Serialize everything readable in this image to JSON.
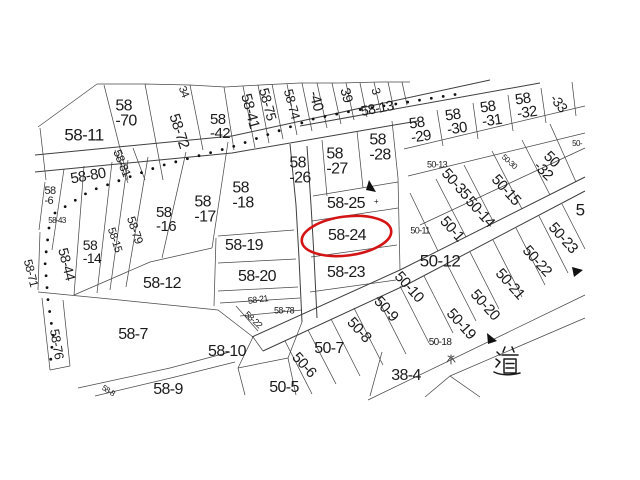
{
  "meta": {
    "type": "cadastral-parcel-map",
    "background_color": "#ffffff",
    "line_color": "#4a4a4a",
    "text_color": "#1b1b1b",
    "highlight_color": "#d41414",
    "highlighted_parcel": "58-24"
  },
  "map": {
    "road_label": "道",
    "water_mark": "水",
    "labels": [
      {
        "t": "58-11",
        "x": 84,
        "y": 135,
        "r": 0,
        "s": 17
      },
      {
        "t": "58\n-70",
        "x": 126,
        "y": 114,
        "r": 0,
        "s": 16
      },
      {
        "t": "58-72",
        "x": 179,
        "y": 131,
        "r": 72,
        "s": 15
      },
      {
        "t": "34",
        "x": 183,
        "y": 92,
        "r": 68,
        "s": 11
      },
      {
        "t": "58\n-42",
        "x": 220,
        "y": 127,
        "r": 0,
        "s": 15
      },
      {
        "t": "58-41",
        "x": 250,
        "y": 111,
        "r": 75,
        "s": 15
      },
      {
        "t": "58-75",
        "x": 268,
        "y": 104,
        "r": 75,
        "s": 14
      },
      {
        "t": "58-74",
        "x": 292,
        "y": 104,
        "r": 75,
        "s": 13
      },
      {
        "t": "-40",
        "x": 316,
        "y": 101,
        "r": 75,
        "s": 15
      },
      {
        "t": "39",
        "x": 347,
        "y": 95,
        "r": 75,
        "s": 14
      },
      {
        "t": "3",
        "x": 376,
        "y": 91,
        "r": 75,
        "s": 12
      },
      {
        "t": "58-13",
        "x": 377,
        "y": 108,
        "r": -11,
        "s": 14
      },
      {
        "t": "58\n-29",
        "x": 420,
        "y": 130,
        "r": -8,
        "s": 15
      },
      {
        "t": "58\n-30",
        "x": 456,
        "y": 122,
        "r": -8,
        "s": 15
      },
      {
        "t": "58\n-31",
        "x": 491,
        "y": 114,
        "r": -8,
        "s": 15
      },
      {
        "t": "58\n-32",
        "x": 526,
        "y": 106,
        "r": -8,
        "s": 15
      },
      {
        "t": "-33",
        "x": 559,
        "y": 103,
        "r": 52,
        "s": 14
      },
      {
        "t": "58-80",
        "x": 88,
        "y": 176,
        "r": -10,
        "s": 15
      },
      {
        "t": "58-81",
        "x": 122,
        "y": 163,
        "r": 68,
        "s": 12
      },
      {
        "t": "58\n-6",
        "x": 50,
        "y": 196,
        "r": 0,
        "s": 11
      },
      {
        "t": "58-43",
        "x": 57,
        "y": 221,
        "r": 0,
        "s": 8
      },
      {
        "t": "58-44",
        "x": 67,
        "y": 264,
        "r": 76,
        "s": 14
      },
      {
        "t": "58-71",
        "x": 31,
        "y": 273,
        "r": 76,
        "s": 12
      },
      {
        "t": "58\n-14",
        "x": 92,
        "y": 252,
        "r": 0,
        "s": 14
      },
      {
        "t": "58-15",
        "x": 114,
        "y": 240,
        "r": 72,
        "s": 11
      },
      {
        "t": "58-79",
        "x": 135,
        "y": 230,
        "r": 72,
        "s": 12
      },
      {
        "t": "58\n-16",
        "x": 166,
        "y": 220,
        "r": 0,
        "s": 15
      },
      {
        "t": "58\n-17",
        "x": 205,
        "y": 210,
        "r": 0,
        "s": 16
      },
      {
        "t": "58\n-18",
        "x": 243,
        "y": 196,
        "r": 0,
        "s": 16
      },
      {
        "t": "58-12",
        "x": 162,
        "y": 284,
        "r": 0,
        "s": 16
      },
      {
        "t": "58-19",
        "x": 244,
        "y": 246,
        "r": 0,
        "s": 16
      },
      {
        "t": "58-20",
        "x": 257,
        "y": 277,
        "r": 0,
        "s": 16
      },
      {
        "t": "58\n-26",
        "x": 300,
        "y": 171,
        "r": 0,
        "s": 16
      },
      {
        "t": "58\n-27",
        "x": 337,
        "y": 162,
        "r": 0,
        "s": 16
      },
      {
        "t": "58\n-28",
        "x": 380,
        "y": 148,
        "r": 0,
        "s": 16
      },
      {
        "t": "58-25",
        "x": 346,
        "y": 204,
        "r": 0,
        "s": 16
      },
      {
        "t": "58-24",
        "x": 347,
        "y": 236,
        "r": 0,
        "s": 16
      },
      {
        "t": "58-23",
        "x": 346,
        "y": 273,
        "r": 0,
        "s": 16
      },
      {
        "t": "58-76",
        "x": 57,
        "y": 344,
        "r": 80,
        "s": 13
      },
      {
        "t": "58-7",
        "x": 133,
        "y": 335,
        "r": 0,
        "s": 16
      },
      {
        "t": "58-9",
        "x": 168,
        "y": 390,
        "r": 0,
        "s": 16
      },
      {
        "t": "58-8",
        "x": 108,
        "y": 391,
        "r": 33,
        "s": 8
      },
      {
        "t": "58-10",
        "x": 227,
        "y": 352,
        "r": 0,
        "s": 16
      },
      {
        "t": "58-21",
        "x": 258,
        "y": 300,
        "r": -8,
        "s": 9
      },
      {
        "t": "58-78",
        "x": 284,
        "y": 311,
        "r": 0,
        "s": 9
      },
      {
        "t": "58-22",
        "x": 253,
        "y": 320,
        "r": 42,
        "s": 9
      },
      {
        "t": "50-13",
        "x": 437,
        "y": 165,
        "r": 0,
        "s": 9
      },
      {
        "t": "50-35",
        "x": 456,
        "y": 184,
        "r": 48,
        "s": 15
      },
      {
        "t": "50-30",
        "x": 509,
        "y": 162,
        "r": 42,
        "s": 8
      },
      {
        "t": "50\n-32",
        "x": 548,
        "y": 166,
        "r": 45,
        "s": 15
      },
      {
        "t": "50-15",
        "x": 506,
        "y": 190,
        "r": 48,
        "s": 15
      },
      {
        "t": "50-14",
        "x": 480,
        "y": 212,
        "r": 48,
        "s": 15
      },
      {
        "t": "50-1",
        "x": 452,
        "y": 229,
        "r": 48,
        "s": 15
      },
      {
        "t": "50-11",
        "x": 420,
        "y": 231,
        "r": 0,
        "s": 9
      },
      {
        "t": "50-12",
        "x": 440,
        "y": 261,
        "r": 0,
        "s": 17
      },
      {
        "t": "50-23",
        "x": 563,
        "y": 238,
        "r": 48,
        "s": 15
      },
      {
        "t": "50-22",
        "x": 537,
        "y": 261,
        "r": 48,
        "s": 15
      },
      {
        "t": "50-21",
        "x": 510,
        "y": 284,
        "r": 48,
        "s": 15
      },
      {
        "t": "50-20",
        "x": 485,
        "y": 305,
        "r": 48,
        "s": 15
      },
      {
        "t": "50-19",
        "x": 461,
        "y": 324,
        "r": 48,
        "s": 15
      },
      {
        "t": "50-18",
        "x": 440,
        "y": 343,
        "r": 0,
        "s": 10
      },
      {
        "t": "50-10",
        "x": 409,
        "y": 287,
        "r": 48,
        "s": 15
      },
      {
        "t": "50-9",
        "x": 386,
        "y": 309,
        "r": 48,
        "s": 15
      },
      {
        "t": "50-8",
        "x": 359,
        "y": 330,
        "r": 48,
        "s": 15
      },
      {
        "t": "50-7",
        "x": 329,
        "y": 349,
        "r": 0,
        "s": 16
      },
      {
        "t": "50-6",
        "x": 304,
        "y": 365,
        "r": 48,
        "s": 15
      },
      {
        "t": "50-5",
        "x": 284,
        "y": 388,
        "r": 0,
        "s": 16
      },
      {
        "t": "38-4",
        "x": 406,
        "y": 376,
        "r": 0,
        "s": 16
      },
      {
        "t": "5",
        "x": 580,
        "y": 210,
        "r": 0,
        "s": 17
      },
      {
        "t": "50-",
        "x": 577,
        "y": 144,
        "r": 0,
        "s": 8
      },
      {
        "t": "+",
        "x": 376,
        "y": 202,
        "r": 0,
        "s": 8
      }
    ]
  }
}
